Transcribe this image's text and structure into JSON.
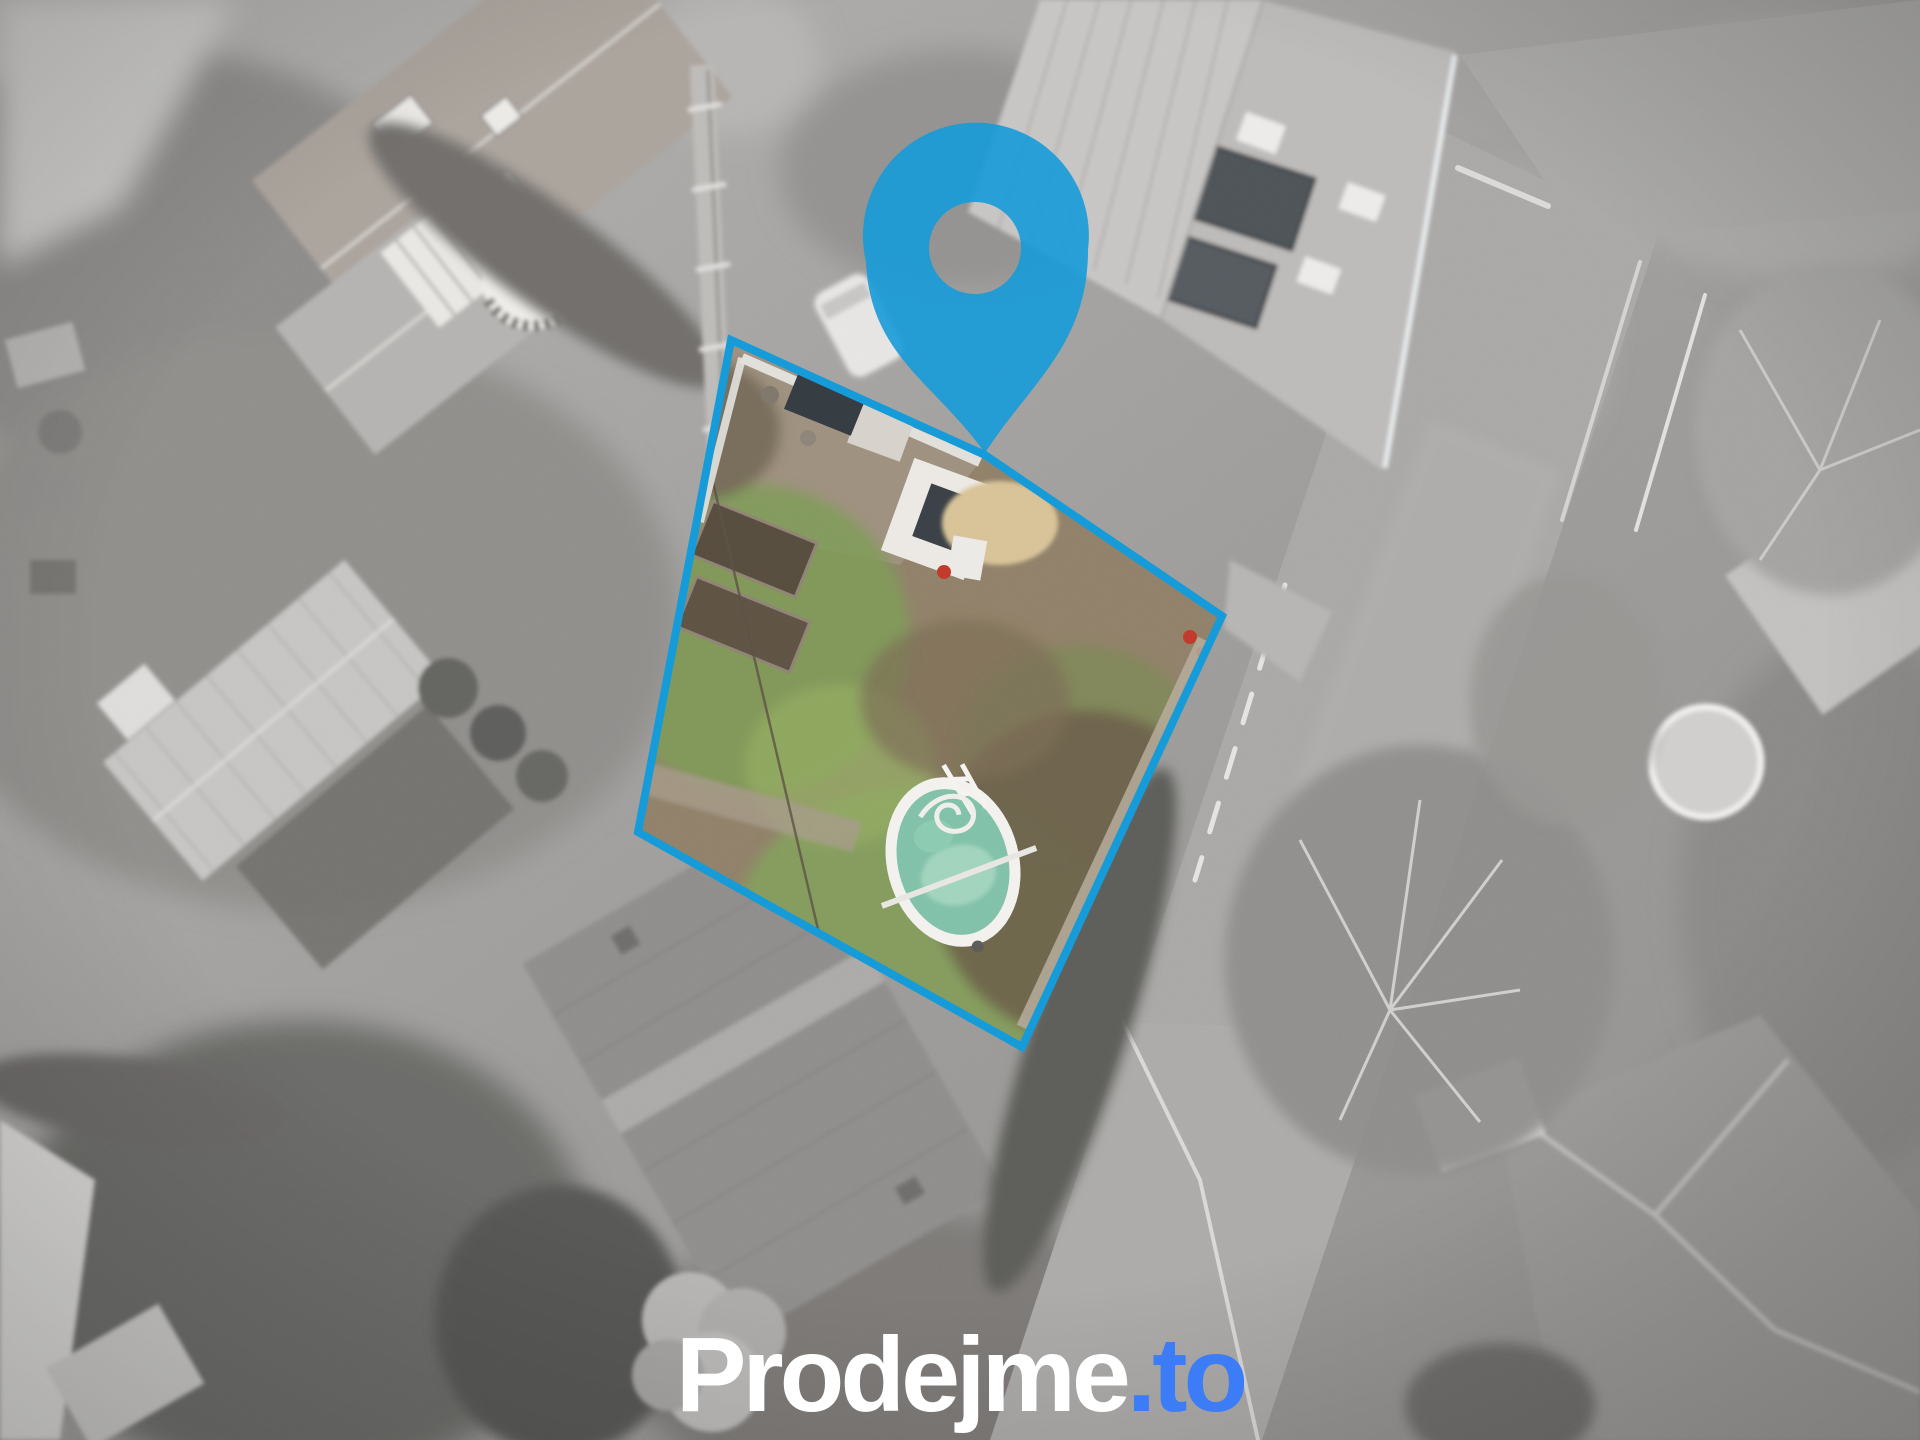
{
  "brand": {
    "logo_main": "Prodejme",
    "logo_suffix": ".to",
    "logo_full": "Prodejme.to"
  },
  "icons": {
    "pin": "location-pin-icon"
  },
  "colors": {
    "pin_blue": "#1598d8",
    "parcel_outline_blue": "#1598d8",
    "logo_main_white": "#ffffff",
    "logo_suffix_blue": "#3c7cf6",
    "pool_water_teal": "#7fc0a8",
    "moss_green": "#7d9a55",
    "soil_brown": "#8f7f68",
    "sand_beige": "#d8c296"
  }
}
